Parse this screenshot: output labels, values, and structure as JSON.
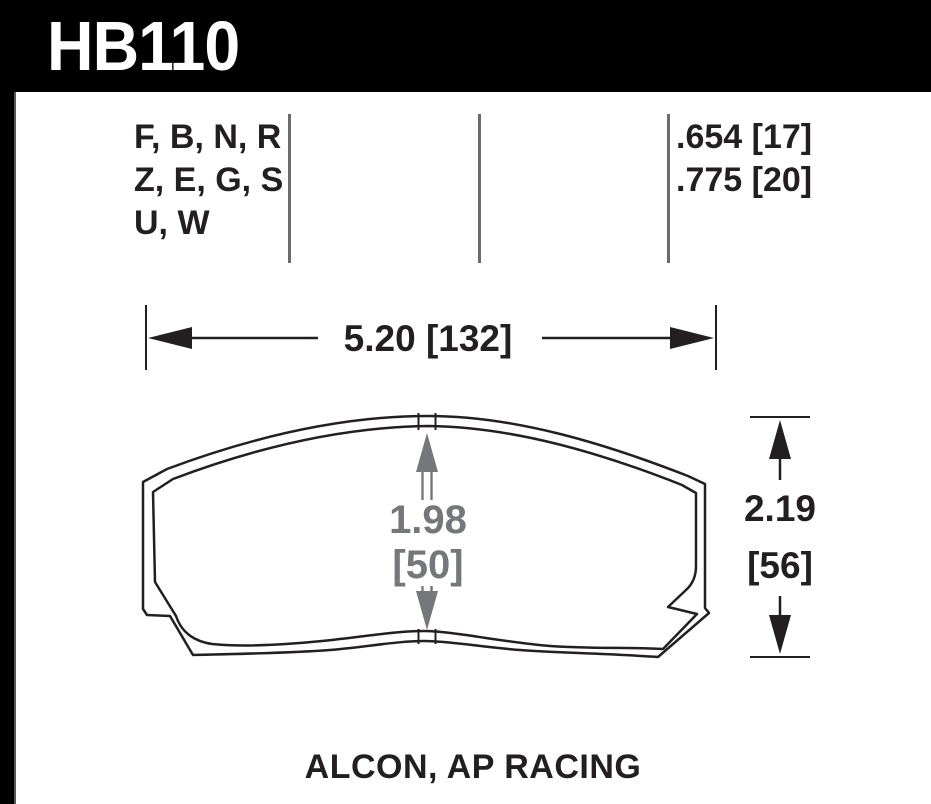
{
  "header": {
    "part_number": "HB110"
  },
  "spec_table": {
    "compound_rows": "F, B, N, R\nZ, E, G, S\nU, W",
    "thickness_rows": ".654 [17]\n.775 [20]"
  },
  "dimensions": {
    "width": "5.20 [132]",
    "height_value": "2.19",
    "height_mm": "[56]",
    "center_value": "1.98",
    "center_mm": "[50]"
  },
  "footer": {
    "applications": "ALCON, AP RACING"
  },
  "colors": {
    "ink": "#231f20",
    "dimension_gray": "#76777a",
    "divider_gray": "#6a6b6e",
    "header_background": "#000000",
    "background": "#ffffff"
  }
}
